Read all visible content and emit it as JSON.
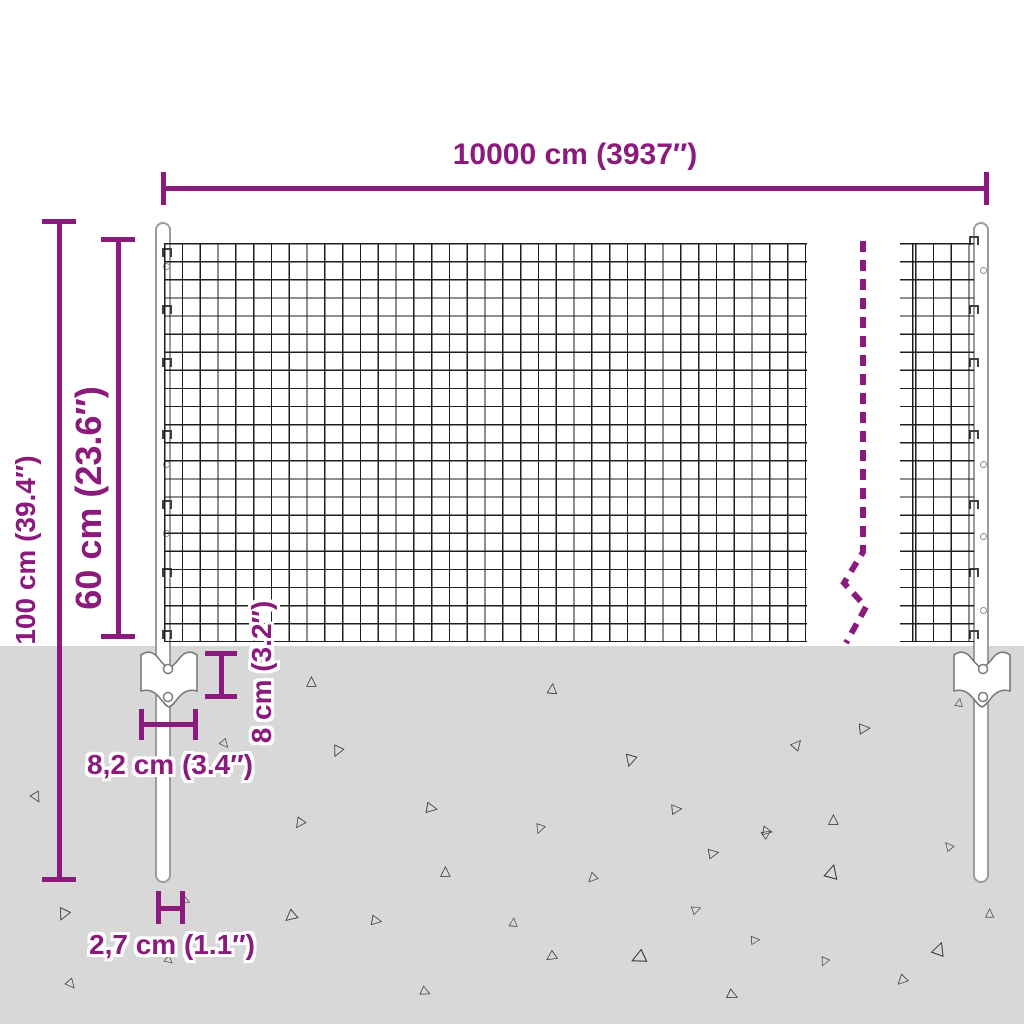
{
  "title": "Wire mesh fence dimension diagram",
  "colors": {
    "accent": "#8b1a7d",
    "ground": "#d8d8d8",
    "wire": "#1d1d1d",
    "post_outline": "#9c9c9c"
  },
  "dimensions": {
    "width_label": "10000 cm (3937″)",
    "height_total_label": "100 cm (39.4″)",
    "height_mesh_label": "60 cm (23.6″)",
    "anchor_height_label": "8 cm (3.2″)",
    "anchor_width_label": "8,2 cm (3.4″)",
    "post_width_label": "2,7 cm (1.1″)"
  },
  "decor": {
    "left_hook_ys": [
      248,
      305,
      358,
      430,
      500,
      568,
      630
    ],
    "right_hook_ys": [
      236,
      305,
      358,
      430,
      500,
      568,
      630
    ],
    "left_hole_points": [
      [
        166,
        266
      ],
      [
        166,
        464
      ],
      [
        166,
        533
      ]
    ],
    "right_hole_points": [
      [
        983,
        270
      ],
      [
        983,
        464
      ],
      [
        983,
        536
      ],
      [
        983,
        610
      ]
    ],
    "triangles": [
      [
        313,
        680,
        14,
        0
      ],
      [
        554,
        687,
        14,
        5
      ],
      [
        867,
        728,
        15,
        85
      ],
      [
        800,
        743,
        14,
        40
      ],
      [
        632,
        761,
        16,
        195
      ],
      [
        338,
        752,
        15,
        205
      ],
      [
        227,
        745,
        12,
        140
      ],
      [
        39,
        799,
        14,
        150
      ],
      [
        434,
        808,
        15,
        100
      ],
      [
        300,
        825,
        14,
        215
      ],
      [
        680,
        809,
        14,
        85
      ],
      [
        835,
        818,
        14,
        0
      ],
      [
        540,
        830,
        13,
        200
      ],
      [
        770,
        831,
        13,
        100
      ],
      [
        960,
        702,
        11,
        10
      ],
      [
        65,
        915,
        16,
        205
      ],
      [
        188,
        901,
        12,
        115
      ],
      [
        170,
        960,
        11,
        130
      ],
      [
        73,
        985,
        13,
        140
      ],
      [
        292,
        917,
        16,
        230
      ],
      [
        380,
        921,
        14,
        100
      ],
      [
        447,
        870,
        14,
        0
      ],
      [
        428,
        992,
        13,
        115
      ],
      [
        592,
        879,
        13,
        225
      ],
      [
        717,
        853,
        14,
        80
      ],
      [
        834,
        870,
        19,
        15
      ],
      [
        769,
        833,
        12,
        55
      ],
      [
        949,
        845,
        12,
        320
      ],
      [
        515,
        921,
        12,
        5
      ],
      [
        699,
        909,
        12,
        70
      ],
      [
        551,
        958,
        14,
        235
      ],
      [
        639,
        958,
        19,
        245
      ],
      [
        758,
        940,
        12,
        85
      ],
      [
        825,
        963,
        12,
        205
      ],
      [
        942,
        947,
        18,
        20
      ],
      [
        902,
        982,
        14,
        225
      ],
      [
        736,
        996,
        14,
        115
      ],
      [
        991,
        912,
        12,
        0
      ]
    ]
  }
}
